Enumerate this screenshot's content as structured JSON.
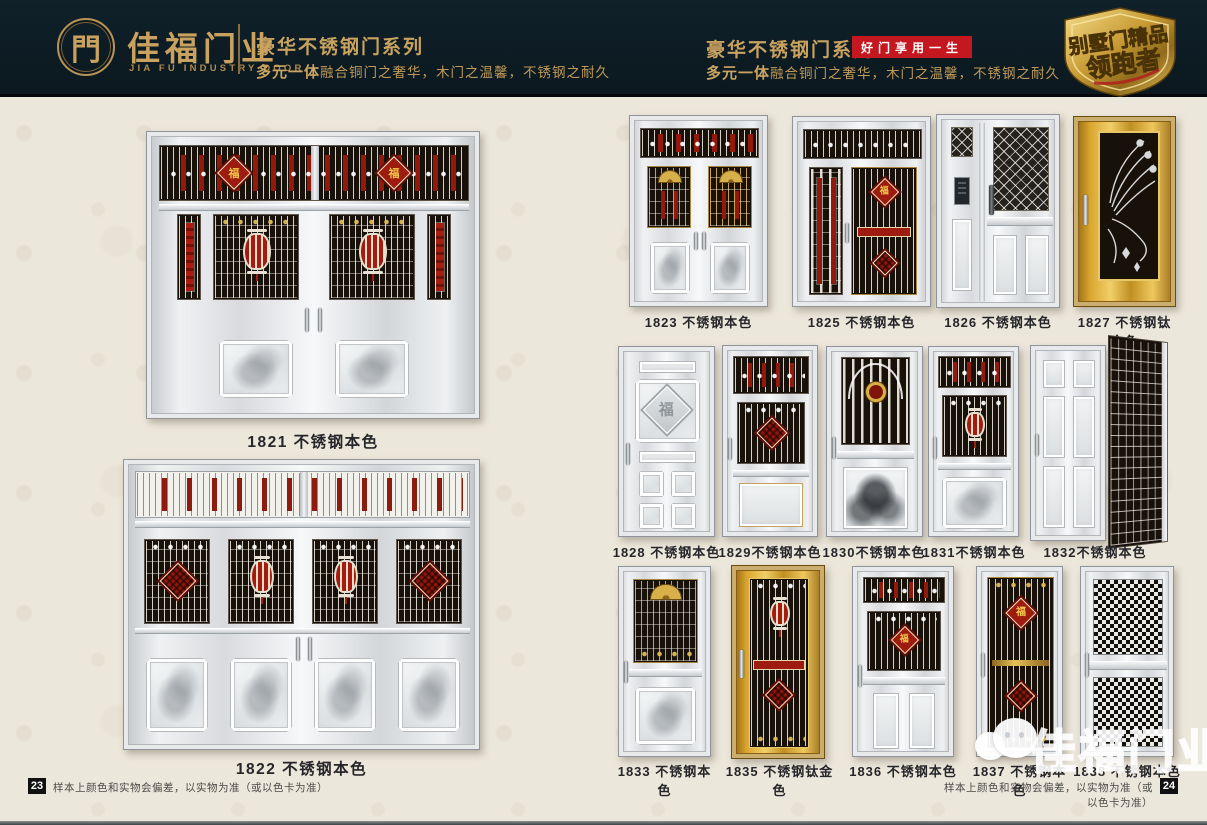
{
  "header": {
    "logo": {
      "symbol": "門",
      "brand_cn": "佳福门业",
      "brand_en": "JIA FU INDUSTRY DOOR"
    },
    "left_section": {
      "title": "豪华不锈钢门系列",
      "subtitle_lead": "多元一体",
      "subtitle_rest": "融合铜门之奢华，木门之温馨，不锈钢之耐久"
    },
    "right_section": {
      "title": "豪华不锈钢门系列",
      "badge": "好门享用一生",
      "subtitle_lead": "多元一体",
      "subtitle_rest": "融合铜门之奢华，木门之温馨，不锈钢之耐久"
    },
    "shield_badge": {
      "line1": "别墅门精品",
      "line2": "领跑者"
    }
  },
  "ornaments": {
    "fu_character": "福"
  },
  "left_page": {
    "doors": [
      {
        "model": "1821",
        "finish": "不锈钢本色",
        "label": "1821 不锈钢本色"
      },
      {
        "model": "1822",
        "finish": "不锈钢本色",
        "label": "1822 不锈钢本色"
      }
    ],
    "footer": {
      "page_number": "23",
      "disclaimer": "样本上颜色和实物会偏差，以实物为准（或以色卡为准）"
    }
  },
  "right_page": {
    "row1": [
      {
        "model": "1823",
        "finish": "不锈钢本色",
        "label": "1823 不锈钢本色"
      },
      {
        "model": "1825",
        "finish": "不锈钢本色",
        "label": "1825 不锈钢本色"
      },
      {
        "model": "1826",
        "finish": "不锈钢本色",
        "label": "1826 不锈钢本色"
      },
      {
        "model": "1827",
        "finish": "不锈钢钛金色",
        "label": "1827 不锈钢钛金色"
      }
    ],
    "row2": [
      {
        "model": "1828",
        "finish": "不锈钢本色",
        "label": "1828 不锈钢本色"
      },
      {
        "model": "1829",
        "finish": "不锈钢本色",
        "label": "1829不锈钢本色"
      },
      {
        "model": "1830",
        "finish": "不锈钢本色",
        "label": "1830不锈钢本色"
      },
      {
        "model": "1831",
        "finish": "不锈钢本色",
        "label": "1831不锈钢本色"
      },
      {
        "model": "1832",
        "finish": "不锈钢本色",
        "label": "1832不锈钢本色"
      }
    ],
    "row3": [
      {
        "model": "1833",
        "finish": "不锈钢本色",
        "label": "1833 不锈钢本色"
      },
      {
        "model": "1835",
        "finish": "不锈钢钛金色",
        "label": "1835 不锈钢钛金色"
      },
      {
        "model": "1836",
        "finish": "不锈钢本色",
        "label": "1836 不锈钢本色"
      },
      {
        "model": "1837",
        "finish": "不锈钢本色",
        "label": "1837 不锈钢本色"
      },
      {
        "model": "1838",
        "finish": "不锈钢本色",
        "label": "1838 不锈钢本色"
      }
    ],
    "footer": {
      "page_number": "24",
      "disclaimer": "样本上颜色和实物会偏差，以实物为准（或以色卡为准）"
    },
    "watermark": {
      "text": "佳福门业"
    }
  },
  "colors": {
    "header_bg": "#0d1a21",
    "gold": "#c8a25e",
    "badge_red": "#c5171f",
    "page_bg": "#ece7db",
    "accent_red": "#a21d10",
    "titanium_gold": "#d9a62e"
  }
}
